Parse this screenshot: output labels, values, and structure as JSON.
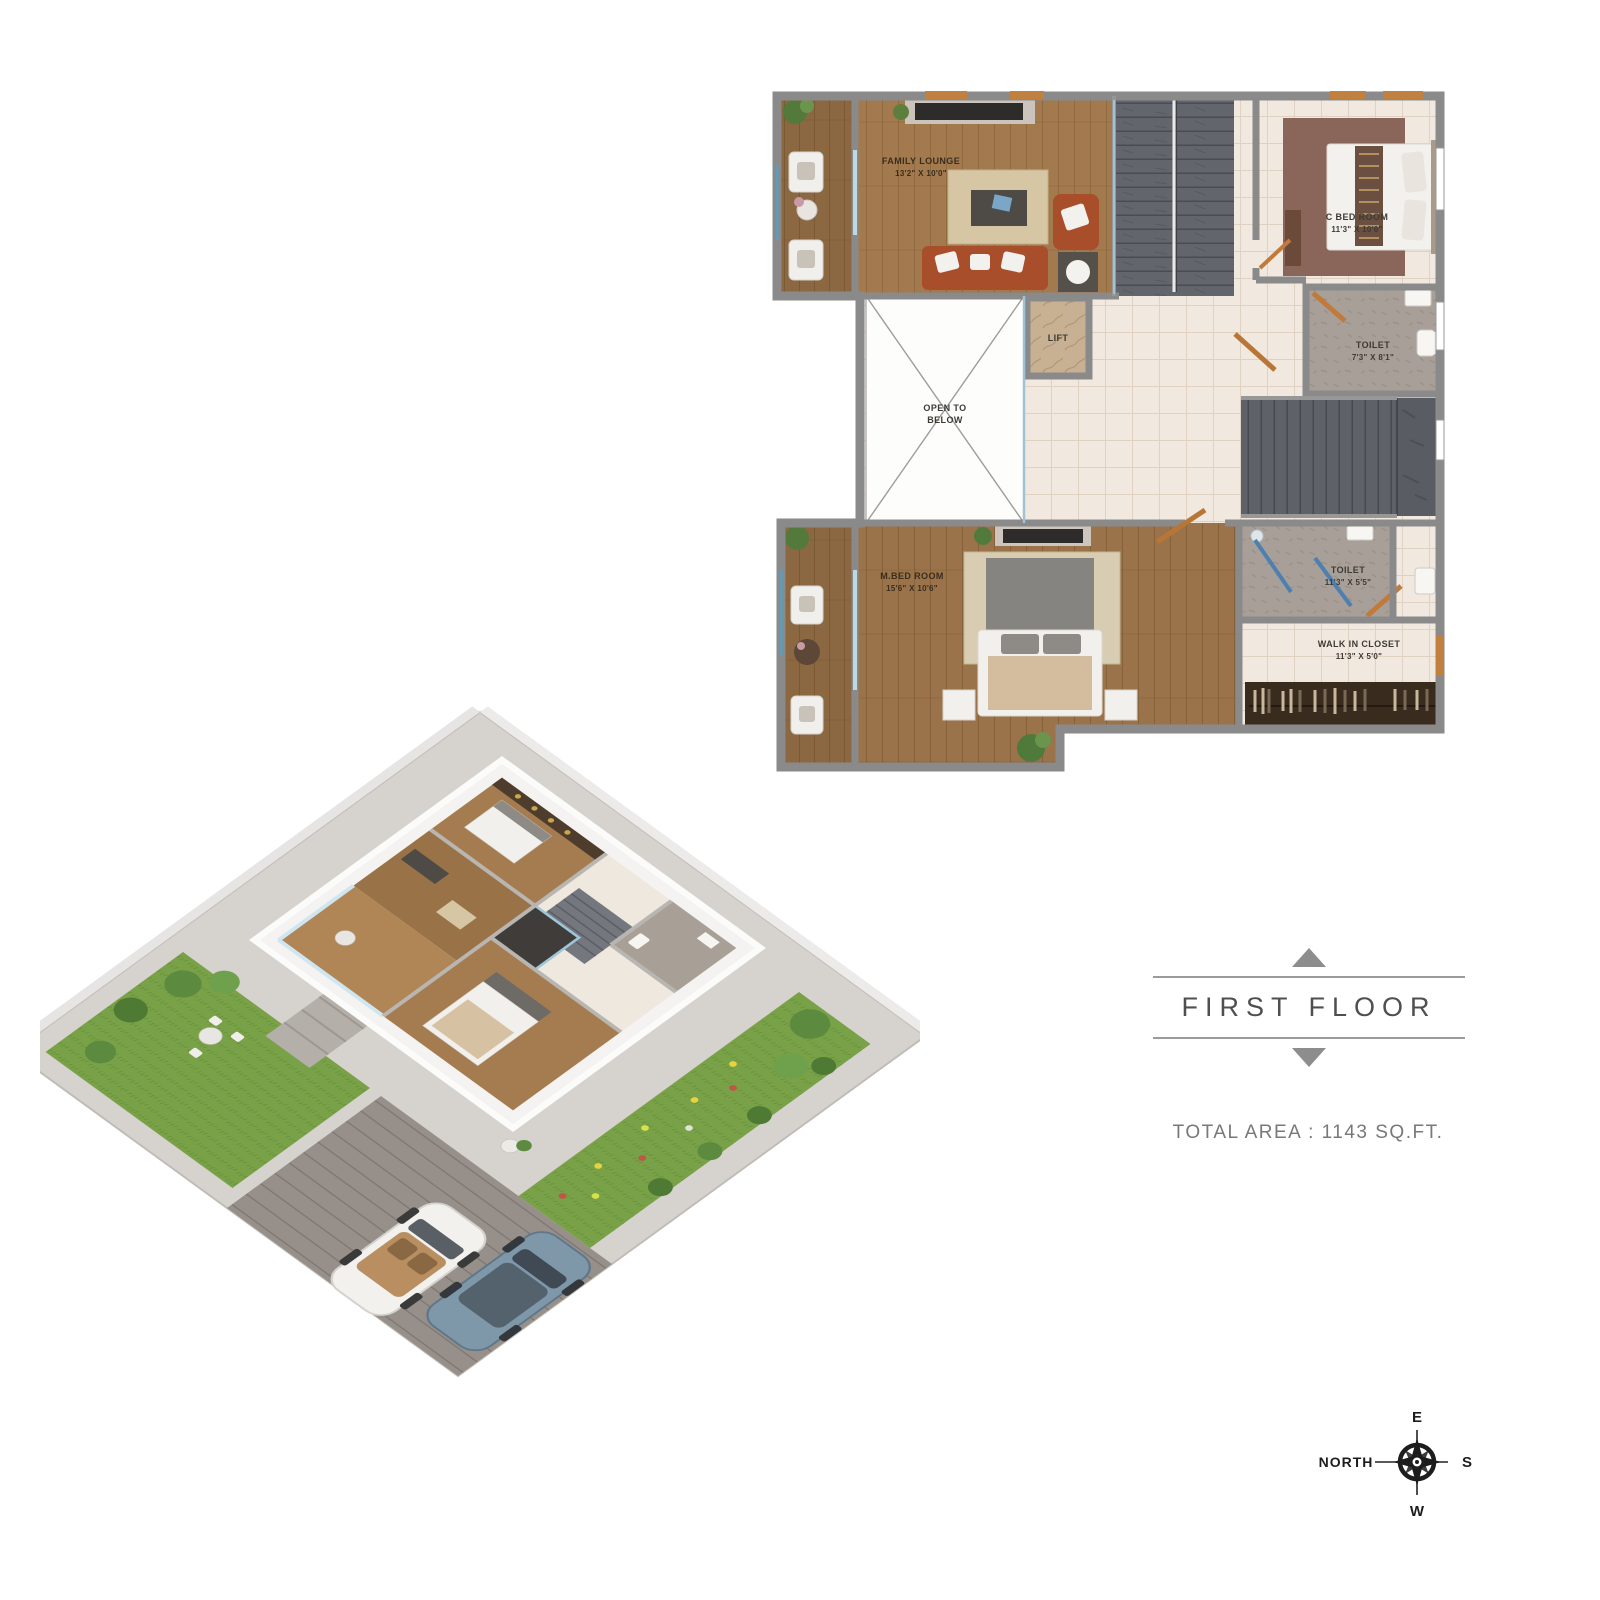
{
  "plan2d": {
    "rooms": {
      "family_lounge": {
        "name": "FAMILY LOUNGE",
        "dims": "13'2\" X 10'0\""
      },
      "c_bedroom": {
        "name": "C BED ROOM",
        "dims": "11'3\" X 10'6\""
      },
      "toilet1": {
        "name": "TOILET",
        "dims": "7'3\" X 8'1\""
      },
      "lift": {
        "name": "LIFT"
      },
      "open_to_below": {
        "line1": "OPEN TO",
        "line2": "BELOW"
      },
      "m_bedroom": {
        "name": "M.BED ROOM",
        "dims": "15'6\" X 10'6\""
      },
      "toilet2": {
        "name": "TOILET",
        "dims": "11'3\" X 5'5\""
      },
      "walk_in_closet": {
        "name": "WALK IN CLOSET",
        "dims": "11'3\" X 5'0\""
      }
    }
  },
  "floor_banner": {
    "title": "FIRST FLOOR"
  },
  "area": {
    "text": "TOTAL AREA : 1143 SQ.FT."
  },
  "compass": {
    "north": "NORTH",
    "e": "E",
    "s": "S",
    "w": "W"
  },
  "colors": {
    "wall": "#8a8a8a",
    "wood_floor": "#9a734a",
    "tile_floor": "#f1e9e0",
    "stair_slate": "#62666c",
    "toilet_gray": "#a8a098",
    "sofa_red": "#a94e2b",
    "door_orange": "#c07a3a",
    "glass_teal": "#9fc3d4",
    "banner_text": "#4f4f4f",
    "area_text": "#787878"
  }
}
